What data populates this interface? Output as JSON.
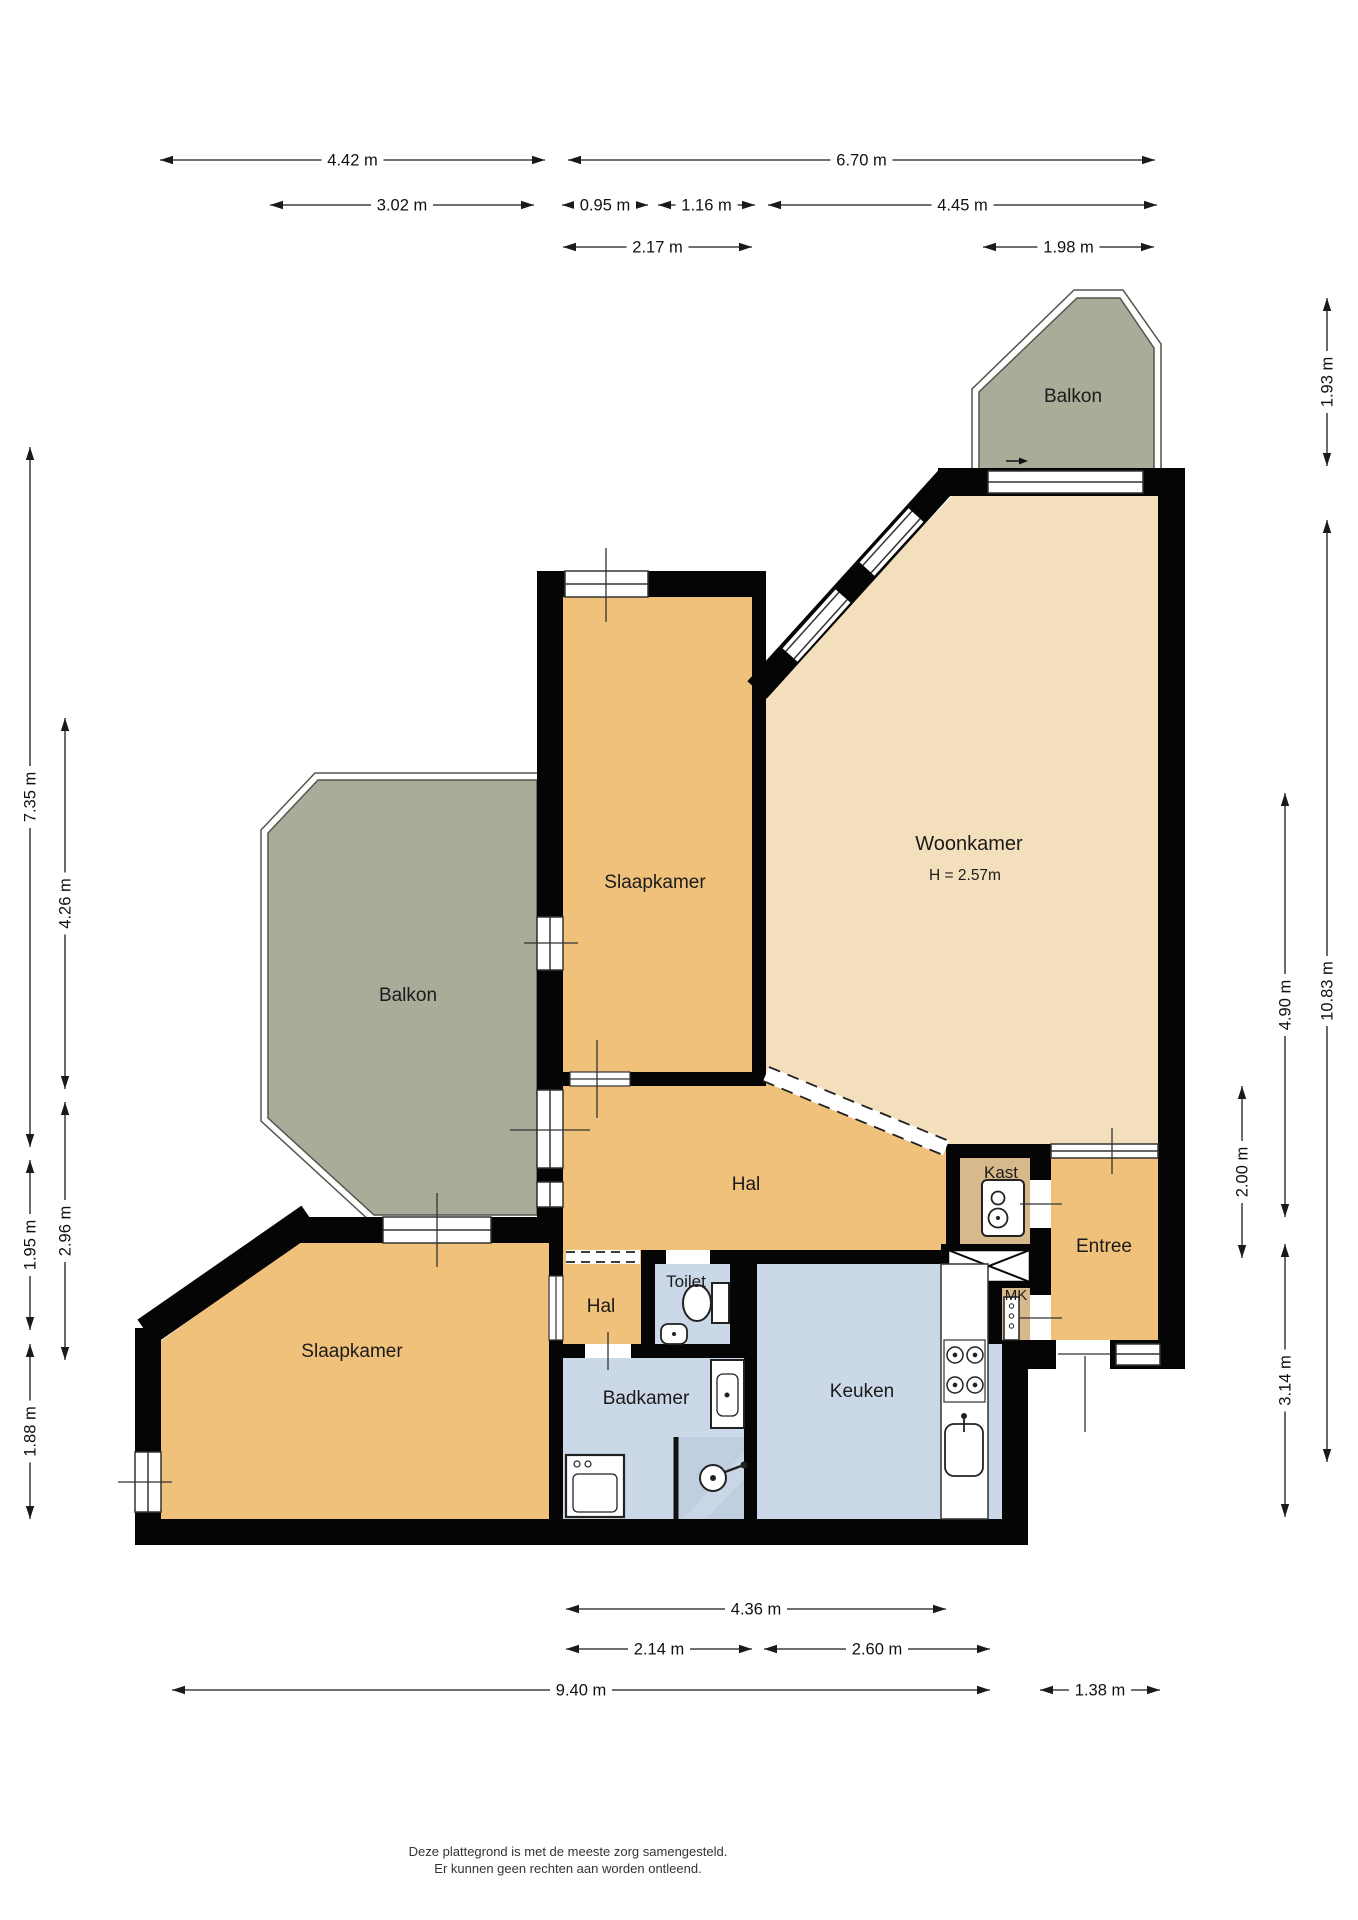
{
  "rooms": {
    "woonkamer": {
      "label": "Woonkamer",
      "ceiling_height": "H = 2.57m"
    },
    "slaapkamer_top": {
      "label": "Slaapkamer"
    },
    "slaapkamer_bottom": {
      "label": "Slaapkamer"
    },
    "balkon_top": {
      "label": "Balkon"
    },
    "balkon_left": {
      "label": "Balkon"
    },
    "hal": {
      "label": "Hal"
    },
    "hal_small": {
      "label": "Hal"
    },
    "kast": {
      "label": "Kast"
    },
    "entree": {
      "label": "Entree"
    },
    "mk": {
      "label": "MK"
    },
    "toilet": {
      "label": "Toilet"
    },
    "badkamer": {
      "label": "Badkamer"
    },
    "keuken": {
      "label": "Keuken"
    }
  },
  "dimensions": {
    "top": [
      {
        "label": "4.42 m"
      },
      {
        "label": "6.70 m"
      },
      {
        "label": "3.02 m"
      },
      {
        "label": "0.95 m"
      },
      {
        "label": "1.16 m"
      },
      {
        "label": "4.45 m"
      },
      {
        "label": "2.17 m"
      },
      {
        "label": "1.98 m"
      }
    ],
    "bottom": [
      {
        "label": "4.36 m"
      },
      {
        "label": "2.14 m"
      },
      {
        "label": "2.60 m"
      },
      {
        "label": "9.40 m"
      },
      {
        "label": "1.38 m"
      }
    ],
    "left": [
      {
        "label": "7.35 m"
      },
      {
        "label": "1.95 m"
      },
      {
        "label": "1.88 m"
      },
      {
        "label": "4.26 m"
      },
      {
        "label": "2.96 m"
      }
    ],
    "right": [
      {
        "label": "1.93 m"
      },
      {
        "label": "10.83 m"
      },
      {
        "label": "4.90 m"
      },
      {
        "label": "2.00 m"
      },
      {
        "label": "3.14 m"
      }
    ]
  },
  "footer": {
    "line1": "Deze plattegrond is met de meeste zorg samengesteld.",
    "line2": "Er kunnen geen rechten aan worden ontleend."
  },
  "colors": {
    "wall": "#050505",
    "room_tan": "#f0c17b",
    "room_light": "#f3dfbc",
    "room_blue": "#cbd8e7",
    "room_blue_dark": "#bfcfe0",
    "balcony": "#a8ac99",
    "closet": "#d8b98c",
    "background": "#ffffff"
  }
}
